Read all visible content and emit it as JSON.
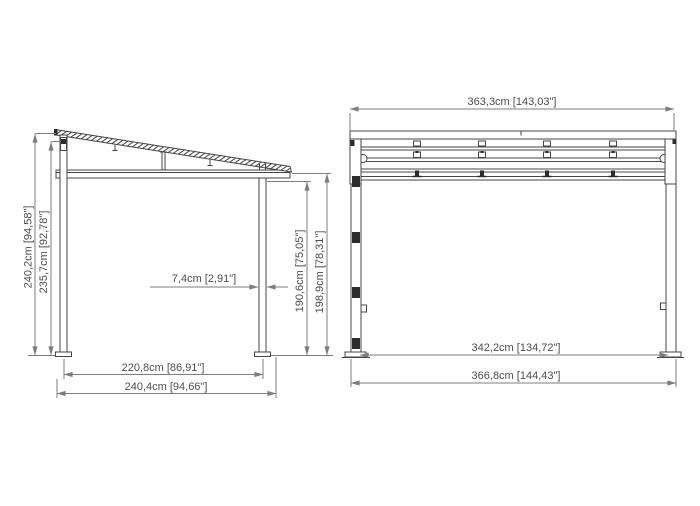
{
  "drawing": {
    "description": "pergola-dimension-drawing",
    "side_view": {
      "dims": {
        "overall_height_back": "240,2cm [94,58\"]",
        "frame_height_back": "235,7cm [92,78\"]",
        "post_width": "7,4cm [2,91\"]",
        "clear_height_front": "190,6cm [75,05\"]",
        "overall_height_front": "198,9cm [78,31\"]",
        "post_spacing_depth": "220,8cm [86,91\"]",
        "overall_depth": "240,4cm [94,66\"]"
      }
    },
    "front_view": {
      "dims": {
        "roof_width": "363,3cm [143,03\"]",
        "post_spacing_width": "342,2cm [134,72\"]",
        "overall_width": "366,8cm [144,43\"]"
      }
    },
    "colors": {
      "background": "#ffffff",
      "structure_line": "#454545",
      "dimension_line": "#7d7d7d",
      "text": "#4d4d4d",
      "connector_fill": "#2c2c2c"
    }
  }
}
